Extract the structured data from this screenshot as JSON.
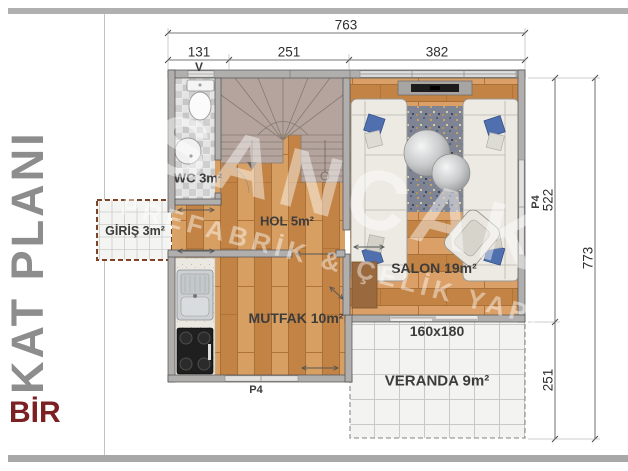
{
  "sidebar": {
    "title": "KAT PLANI",
    "subtitle": "BİR"
  },
  "watermark": {
    "line1": "SANCAK",
    "line2": "PREFABRİK & ÇELİK YAPI"
  },
  "dims": {
    "total_width": "763",
    "seg1": "131",
    "seg2": "251",
    "seg3": "382",
    "right_upper": "522",
    "right_lower": "251",
    "right_total": "773"
  },
  "rooms": {
    "wc": "WC 3m²",
    "hol": "HOL 5m²",
    "giris": "GİRİŞ 3m²",
    "mutfak": "MUTFAK 10m²",
    "salon": "SALON 19m²",
    "veranda": "VERANDA 9m²"
  },
  "openings": {
    "vent": "V",
    "window_bottom": "P4",
    "window_right": "P4",
    "sliding_door": "160x180"
  },
  "colors": {
    "accent_maroon": "#7b2023",
    "title_gray": "#8d8d8d",
    "wood": "#cf9254",
    "stairs": "#b4a49d",
    "wall": "#b1afad"
  }
}
